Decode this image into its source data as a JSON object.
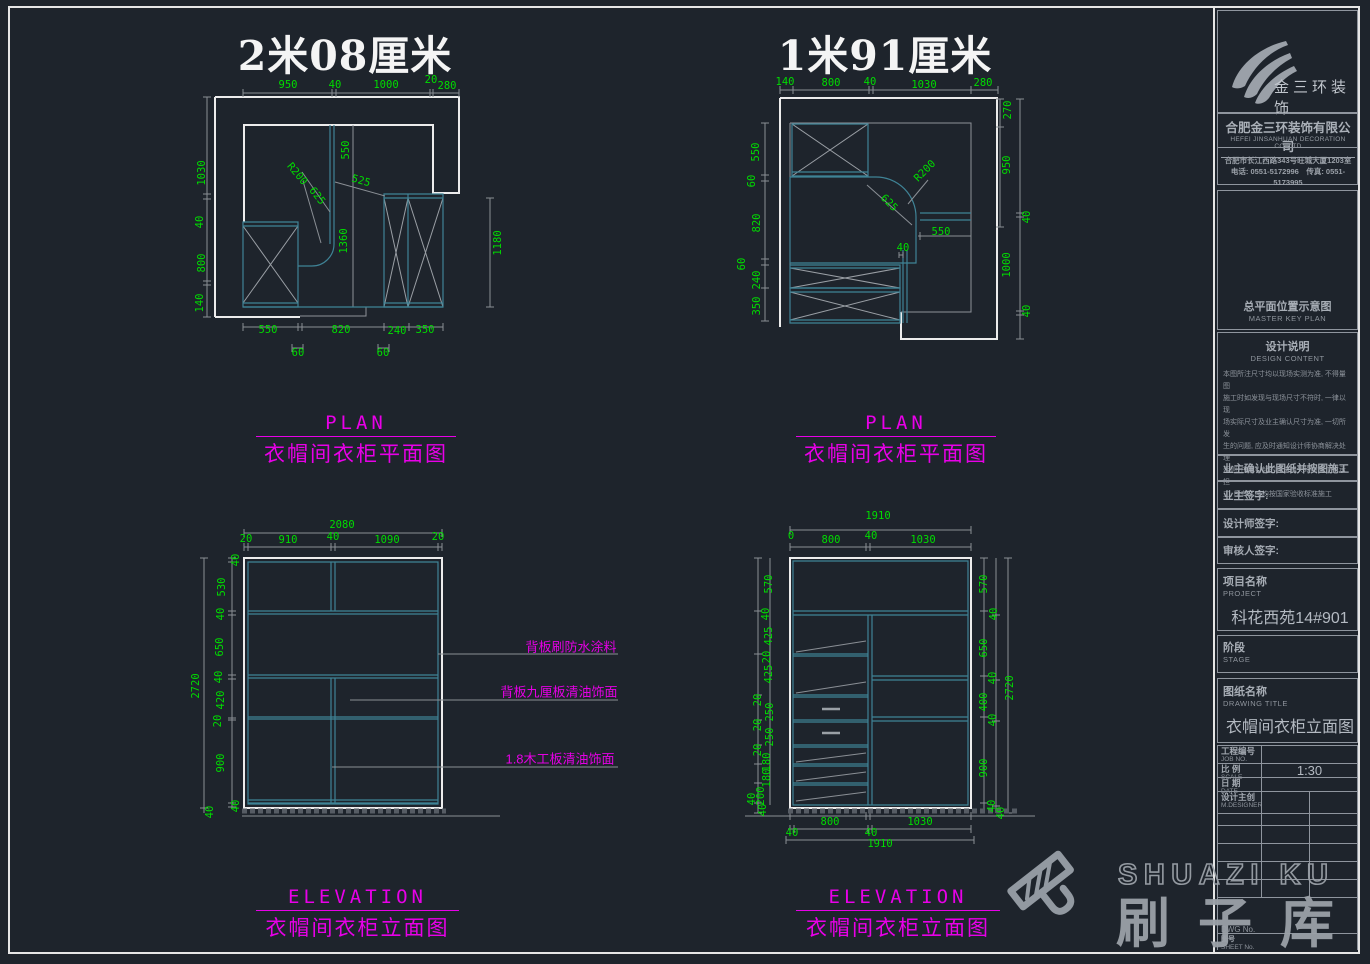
{
  "titles": {
    "plan_left": "2米08厘米",
    "plan_right": "1米91厘米"
  },
  "section_labels": {
    "plan_en": "PLAN",
    "plan_cn": "衣帽间衣柜平面图",
    "elev_en": "ELEVATION",
    "elev_cn": "衣帽间衣柜立面图"
  },
  "annotations": [
    "背板刷防水涂料",
    "背板九厘板清油饰面",
    "1.8木工板清油饰面"
  ],
  "labels": [
    {
      "t": "950",
      "x": 288,
      "y": 85
    },
    {
      "t": "40",
      "x": 335,
      "y": 85
    },
    {
      "t": "1000",
      "x": 386,
      "y": 85
    },
    {
      "t": "20",
      "x": 431,
      "y": 80
    },
    {
      "t": "280",
      "x": 447,
      "y": 86
    },
    {
      "t": "1030",
      "x": 202,
      "y": 173,
      "r": -90
    },
    {
      "t": "40",
      "x": 200,
      "y": 222,
      "r": -90
    },
    {
      "t": "800",
      "x": 202,
      "y": 263,
      "r": -90
    },
    {
      "t": "140",
      "x": 200,
      "y": 303,
      "r": -90
    },
    {
      "t": "550",
      "x": 346,
      "y": 150,
      "r": -90
    },
    {
      "t": "R200",
      "x": 297,
      "y": 174,
      "r": 50
    },
    {
      "t": "625",
      "x": 317,
      "y": 196,
      "r": 52
    },
    {
      "t": "525",
      "x": 361,
      "y": 181,
      "r": 16
    },
    {
      "t": "1360",
      "x": 344,
      "y": 241,
      "r": -90
    },
    {
      "t": "1180",
      "x": 498,
      "y": 243,
      "r": -90
    },
    {
      "t": "550",
      "x": 268,
      "y": 330
    },
    {
      "t": "820",
      "x": 341,
      "y": 330
    },
    {
      "t": "240",
      "x": 397,
      "y": 331
    },
    {
      "t": "350",
      "x": 425,
      "y": 330
    },
    {
      "t": "60",
      "x": 298,
      "y": 353
    },
    {
      "t": "60",
      "x": 383,
      "y": 353
    },
    {
      "t": "140",
      "x": 785,
      "y": 82
    },
    {
      "t": "800",
      "x": 831,
      "y": 83
    },
    {
      "t": "40",
      "x": 870,
      "y": 82
    },
    {
      "t": "1030",
      "x": 924,
      "y": 85
    },
    {
      "t": "280",
      "x": 983,
      "y": 83
    },
    {
      "t": "550",
      "x": 756,
      "y": 152,
      "r": -90
    },
    {
      "t": "60",
      "x": 752,
      "y": 181,
      "r": -90
    },
    {
      "t": "820",
      "x": 757,
      "y": 223,
      "r": -90
    },
    {
      "t": "60",
      "x": 742,
      "y": 264,
      "r": -90
    },
    {
      "t": "240",
      "x": 757,
      "y": 280,
      "r": -90
    },
    {
      "t": "350",
      "x": 757,
      "y": 306,
      "r": -90
    },
    {
      "t": "270",
      "x": 1008,
      "y": 110,
      "r": -90
    },
    {
      "t": "950",
      "x": 1007,
      "y": 165,
      "r": -90
    },
    {
      "t": "40",
      "x": 1027,
      "y": 217,
      "r": -90
    },
    {
      "t": "1000",
      "x": 1007,
      "y": 265,
      "r": -90
    },
    {
      "t": "40",
      "x": 1027,
      "y": 311,
      "r": -90
    },
    {
      "t": "R200",
      "x": 925,
      "y": 171,
      "r": -45
    },
    {
      "t": "625",
      "x": 889,
      "y": 203,
      "r": 45
    },
    {
      "t": "550",
      "x": 941,
      "y": 232
    },
    {
      "t": "40",
      "x": 903,
      "y": 248
    },
    {
      "t": "2080",
      "x": 342,
      "y": 525
    },
    {
      "t": "20",
      "x": 246,
      "y": 539
    },
    {
      "t": "910",
      "x": 288,
      "y": 540
    },
    {
      "t": "40",
      "x": 333,
      "y": 537
    },
    {
      "t": "1090",
      "x": 387,
      "y": 540
    },
    {
      "t": "20",
      "x": 438,
      "y": 537
    },
    {
      "t": "40",
      "x": 236,
      "y": 560,
      "r": -90
    },
    {
      "t": "530",
      "x": 222,
      "y": 587,
      "r": -90
    },
    {
      "t": "40",
      "x": 221,
      "y": 614,
      "r": -90
    },
    {
      "t": "650",
      "x": 220,
      "y": 647,
      "r": -90
    },
    {
      "t": "40",
      "x": 219,
      "y": 677,
      "r": -90
    },
    {
      "t": "420",
      "x": 221,
      "y": 700,
      "r": -90
    },
    {
      "t": "20",
      "x": 218,
      "y": 721,
      "r": -90
    },
    {
      "t": "900",
      "x": 221,
      "y": 763,
      "r": -90
    },
    {
      "t": "40",
      "x": 236,
      "y": 806,
      "r": -90
    },
    {
      "t": "40",
      "x": 210,
      "y": 812,
      "r": -90
    },
    {
      "t": "2720",
      "x": 196,
      "y": 686,
      "r": -90
    },
    {
      "t": "1910",
      "x": 878,
      "y": 516
    },
    {
      "t": "0",
      "x": 791,
      "y": 536
    },
    {
      "t": "800",
      "x": 831,
      "y": 540
    },
    {
      "t": "40",
      "x": 871,
      "y": 536
    },
    {
      "t": "1030",
      "x": 923,
      "y": 540
    },
    {
      "t": "570",
      "x": 769,
      "y": 584,
      "r": -90
    },
    {
      "t": "40",
      "x": 766,
      "y": 614,
      "r": -90
    },
    {
      "t": "425",
      "x": 769,
      "y": 636,
      "r": -90
    },
    {
      "t": "20",
      "x": 767,
      "y": 657,
      "r": -90
    },
    {
      "t": "425",
      "x": 769,
      "y": 674,
      "r": -90
    },
    {
      "t": "20",
      "x": 758,
      "y": 700,
      "r": -90
    },
    {
      "t": "250",
      "x": 770,
      "y": 712,
      "r": -90
    },
    {
      "t": "20",
      "x": 758,
      "y": 725,
      "r": -90
    },
    {
      "t": "250",
      "x": 770,
      "y": 737,
      "r": -90
    },
    {
      "t": "20",
      "x": 758,
      "y": 750,
      "r": -90
    },
    {
      "t": "180",
      "x": 767,
      "y": 762,
      "r": -90
    },
    {
      "t": "180",
      "x": 767,
      "y": 778,
      "r": -90
    },
    {
      "t": "200",
      "x": 761,
      "y": 796,
      "r": -90
    },
    {
      "t": "40",
      "x": 752,
      "y": 799,
      "r": -90
    },
    {
      "t": "40",
      "x": 763,
      "y": 810,
      "r": -90
    },
    {
      "t": "570",
      "x": 984,
      "y": 584,
      "r": -90
    },
    {
      "t": "40",
      "x": 994,
      "y": 614,
      "r": -90
    },
    {
      "t": "650",
      "x": 984,
      "y": 648,
      "r": -90
    },
    {
      "t": "40",
      "x": 993,
      "y": 678,
      "r": -90
    },
    {
      "t": "400",
      "x": 984,
      "y": 702,
      "r": -90
    },
    {
      "t": "40",
      "x": 993,
      "y": 720,
      "r": -90
    },
    {
      "t": "900",
      "x": 984,
      "y": 768,
      "r": -90
    },
    {
      "t": "40",
      "x": 992,
      "y": 806,
      "r": -90
    },
    {
      "t": "40",
      "x": 1001,
      "y": 813,
      "r": -90
    },
    {
      "t": "2720",
      "x": 1010,
      "y": 688,
      "r": -90
    },
    {
      "t": "800",
      "x": 830,
      "y": 822
    },
    {
      "t": "1030",
      "x": 920,
      "y": 822
    },
    {
      "t": "40",
      "x": 792,
      "y": 833
    },
    {
      "t": "40",
      "x": 871,
      "y": 833
    },
    {
      "t": "1910",
      "x": 880,
      "y": 844
    }
  ],
  "sidebar": {
    "brand": "金三环装饰",
    "company_cn": "合肥金三环装饰有限公司",
    "company_en": "HEFEI JINSANHUAN DECORATION CO.,LTD",
    "address": "合肥市长江西路343号旺城大厦1203室",
    "phones": "电话: 0551-5172996　传真: 0551-5173995",
    "master_key_cn": "总平面位置示意图",
    "master_key_en": "MASTER KEY PLAN",
    "design_cn": "设计说明",
    "design_en": "DESIGN CONTENT",
    "design_notes": [
      "本图所注尺寸均以现场实测为准, 不得量图",
      "施工时如发现与现场尺寸不符时, 一律以现",
      "场实际尺寸及业主确认尺寸为准, 一切所发",
      "生的问题, 应及时通知设计师协商解决处理",
      "否则, 由此引起的经济损失均由施工方承担",
      "工, 所有工序均按国家验收标准施工"
    ],
    "confirm": "业主确认此图纸并按图施工",
    "sign_owner": "业主签字:",
    "sign_designer": "设计师签字:",
    "sign_checker": "审核人签字:",
    "project_cn": "项目名称",
    "project_en": "PROJECT",
    "project_value": "科花西苑14#901",
    "stage_cn": "阶段",
    "stage_en": "STAGE",
    "dwgtitle_cn": "图纸名称",
    "dwgtitle_en": "DRAWING TITLE",
    "dwgtitle_value": "衣帽间衣柜立面图",
    "table": {
      "job_cn": "工程编号",
      "job_en": "JOB NO.",
      "job_val": "",
      "scale_cn": "比 例",
      "scale_en": "SCALE",
      "scale_val": "1:30",
      "date_cn": "日 期",
      "date_en": "DATE",
      "date_val": "",
      "designer_cn": "设计主创",
      "designer_en": "M.DESIGNER",
      "designer_val": "",
      "dwg_en": "DWG No.",
      "sheet_cn": "图号",
      "sheet_en": "SHEET No."
    }
  },
  "watermark": {
    "en": "SHUAZI KU",
    "cn": "刷子库"
  },
  "colors": {
    "bg": "#1e242c",
    "green": "#00dc00",
    "magenta": "#e800e8",
    "teal": "#3f8396",
    "wall": "#ececec",
    "grey": "#8a8f95"
  }
}
